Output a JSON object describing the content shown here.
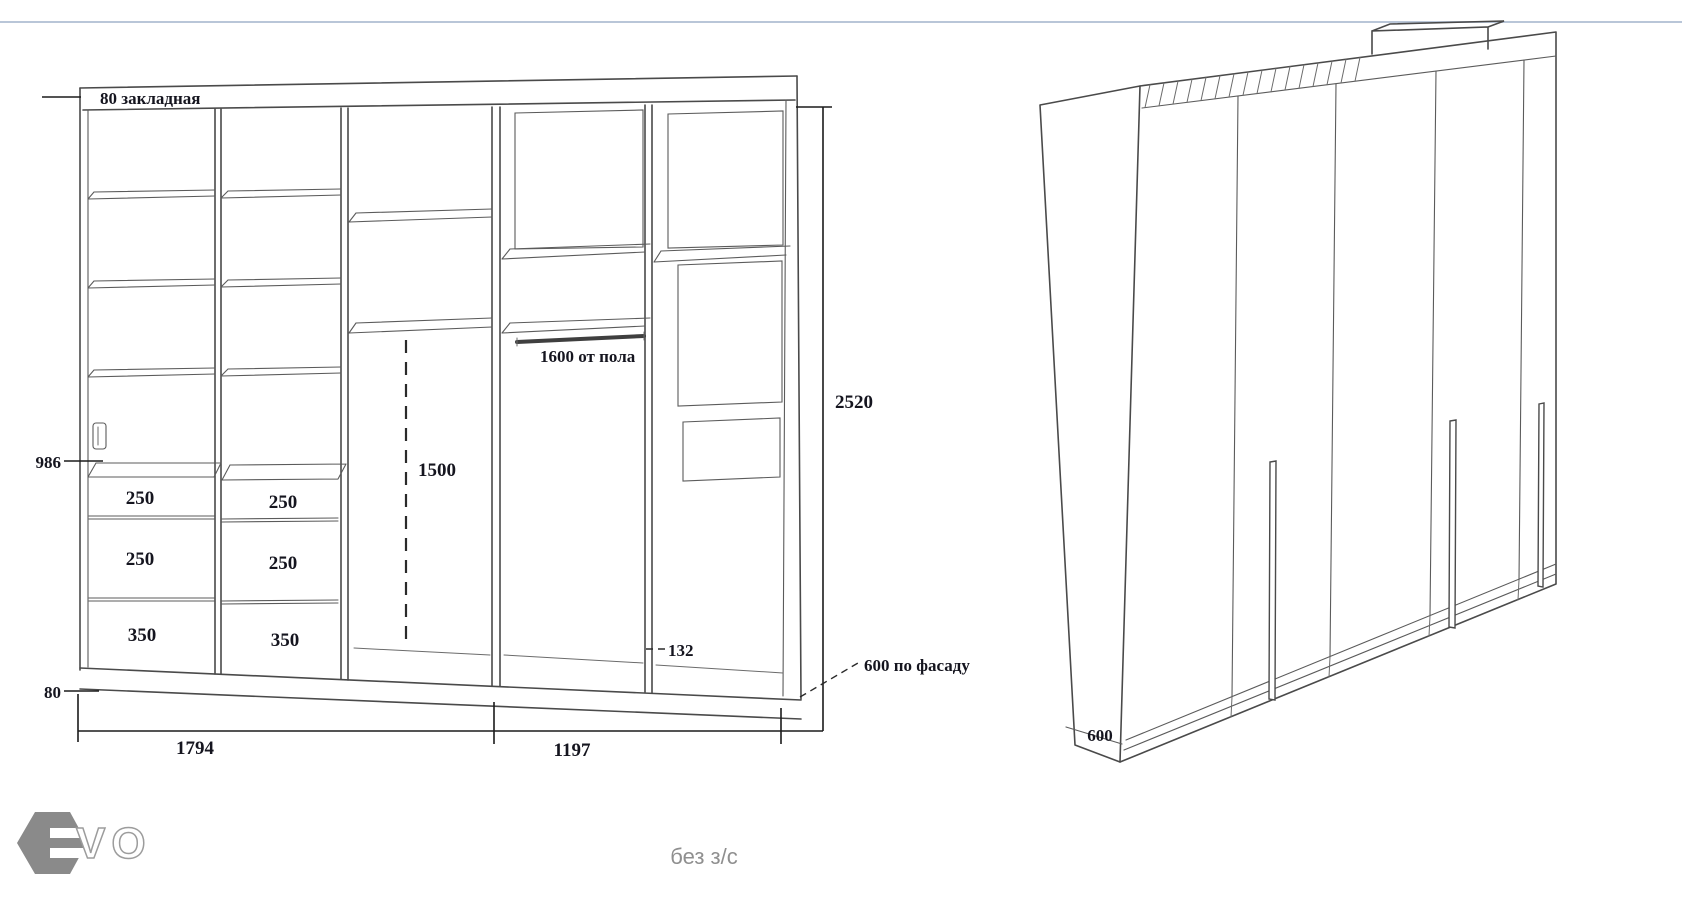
{
  "window": {
    "top_rule_color": "#b9c6d8",
    "background": "#ffffff"
  },
  "front_view": {
    "top_note": "80 закладная",
    "left_dim": "986",
    "plinth_dim": "80",
    "drawers": {
      "col1": [
        "250",
        "250",
        "350"
      ],
      "col2": [
        "250",
        "250",
        "350"
      ]
    },
    "hang_drop_dim": "1500",
    "rod_note": "1600 от пола",
    "niche_dim": "132",
    "height_dim": "2520",
    "width_left_dim": "1794",
    "width_right_dim": "1197",
    "facade_note": "600 по фасаду"
  },
  "iso_view": {
    "depth_dim": "600"
  },
  "footer": {
    "caption": "без з/с",
    "logo_text": "VO"
  }
}
